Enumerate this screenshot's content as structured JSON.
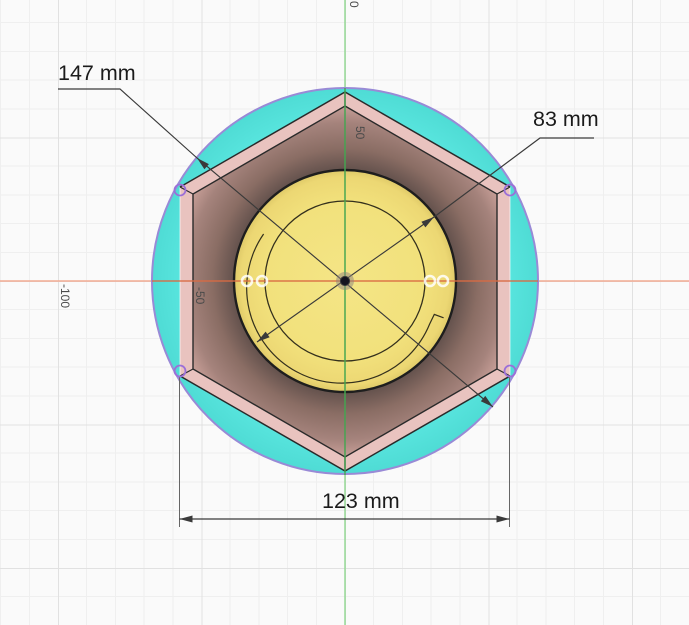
{
  "viewport": {
    "axis_labels": {
      "top_zero": "0",
      "y_plus_50": "50",
      "x_minus_50": "-50",
      "x_minus_100": "-100"
    },
    "dimensions": {
      "disc_diameter": "147 mm",
      "boss_diameter": "83 mm",
      "hex_width": "123 mm"
    },
    "colors": {
      "background": "#fafafa",
      "grid_minor": "#efefef",
      "grid_major": "#e1e1e1",
      "x_axis_light": "#f2ab92",
      "x_axis_strong": "#d96b43",
      "y_axis_light": "#8fd78f",
      "y_axis_strong": "#44a651",
      "disc_fill": "#57e4dd",
      "disc_outline": "#998ad6",
      "hex_chamfer": "#e9c3bf",
      "hex_edge": "#2a2a2a",
      "pocket_dark": "#5c4c48",
      "pocket_mid": "#a5837c",
      "pocket_light": "#e0b5af",
      "boss_fill": "#f2e17c",
      "boss_fill_edge": "#dcc766",
      "boss_edge": "#1e1e1e",
      "boss_inner_edge": "#34301d",
      "vertex_marker": "#9b6fd8",
      "hole_marker": "#ffffff",
      "dimension_line": "#3a3a3a",
      "extension_line": "#666666",
      "dimension_text": "#1b1b1b",
      "axis_label_text": "#4a4a4a"
    }
  }
}
